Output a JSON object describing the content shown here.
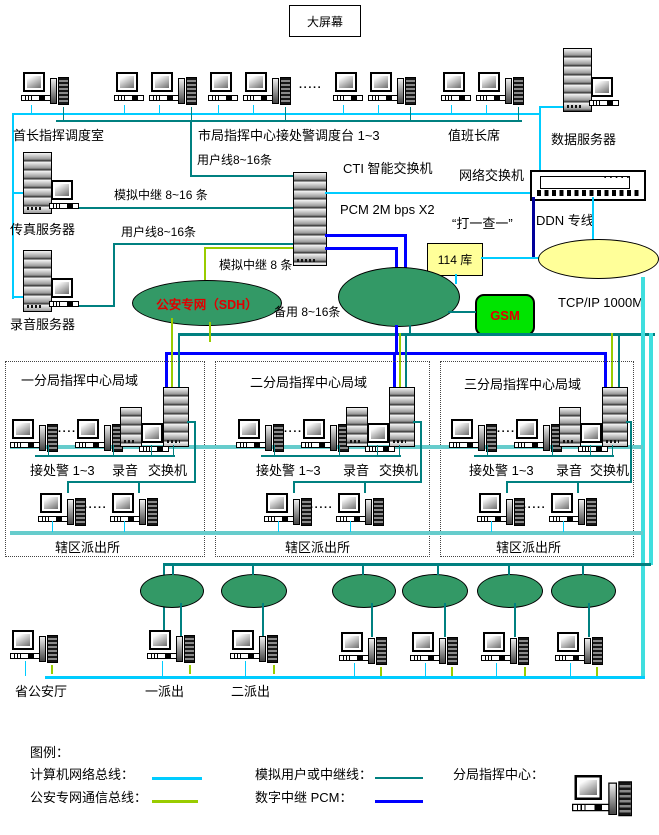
{
  "big_screen": "大屏幕",
  "ellipsis": "·····",
  "top": {
    "chief_room": "首长指挥调度室",
    "city_dispatch": "市局指挥中心接处警调度台 1~3",
    "duty_chief": "值班长席",
    "data_server": "数据服务器",
    "fax_server": "传真服务器",
    "recording_server": "录音服务器"
  },
  "center": {
    "cti_switch": "CTI 智能交换机",
    "network_switch": "网络交换机",
    "pcm": "PCM 2M bps X2",
    "dial_check": "“打一查一”",
    "ddn": "DDN 专线",
    "tcpip": "TCP/IP 1000M",
    "sdh_cloud": "公安专网（SDH）",
    "db114": "114 库",
    "gsm": "GSM",
    "user_line_a": "用户线8~16条",
    "analog_trunk_a": "模拟中继 8~16 条",
    "user_line_b": "用户线8~16条",
    "analog_trunk_b": "模拟中继 8 条",
    "backup_line": "备用 8~16条"
  },
  "divisions": [
    {
      "title": "一分局指挥中心局域",
      "dispatch": "接处警 1~3",
      "recording": "录音",
      "switch_label": "交换机",
      "station": "辖区派出所"
    },
    {
      "title": "二分局指挥中心局域",
      "dispatch": "接处警 1~3",
      "recording": "录音",
      "switch_label": "交换机",
      "station": "辖区派出所"
    },
    {
      "title": "三分局指挥中心局域",
      "dispatch": "接处警 1~3",
      "recording": "录音",
      "switch_label": "交换机",
      "station": "辖区派出所"
    }
  ],
  "bottom": {
    "province": "省公安厅",
    "station1": "一派出",
    "station2": "二派出"
  },
  "legend": {
    "title": "图例：",
    "computer_bus": "计算机网络总线：",
    "security_bus": "公安专网通信总线：",
    "analog_line": "模拟用户或中继线：",
    "digital_pcm": "数字中继 PCM：",
    "division_center": "分局指挥中心：",
    "colors": {
      "computer_bus": "#00CCFF",
      "security_bus": "#99CC00",
      "analog_line": "#008080",
      "digital_pcm": "#0000FF"
    }
  }
}
